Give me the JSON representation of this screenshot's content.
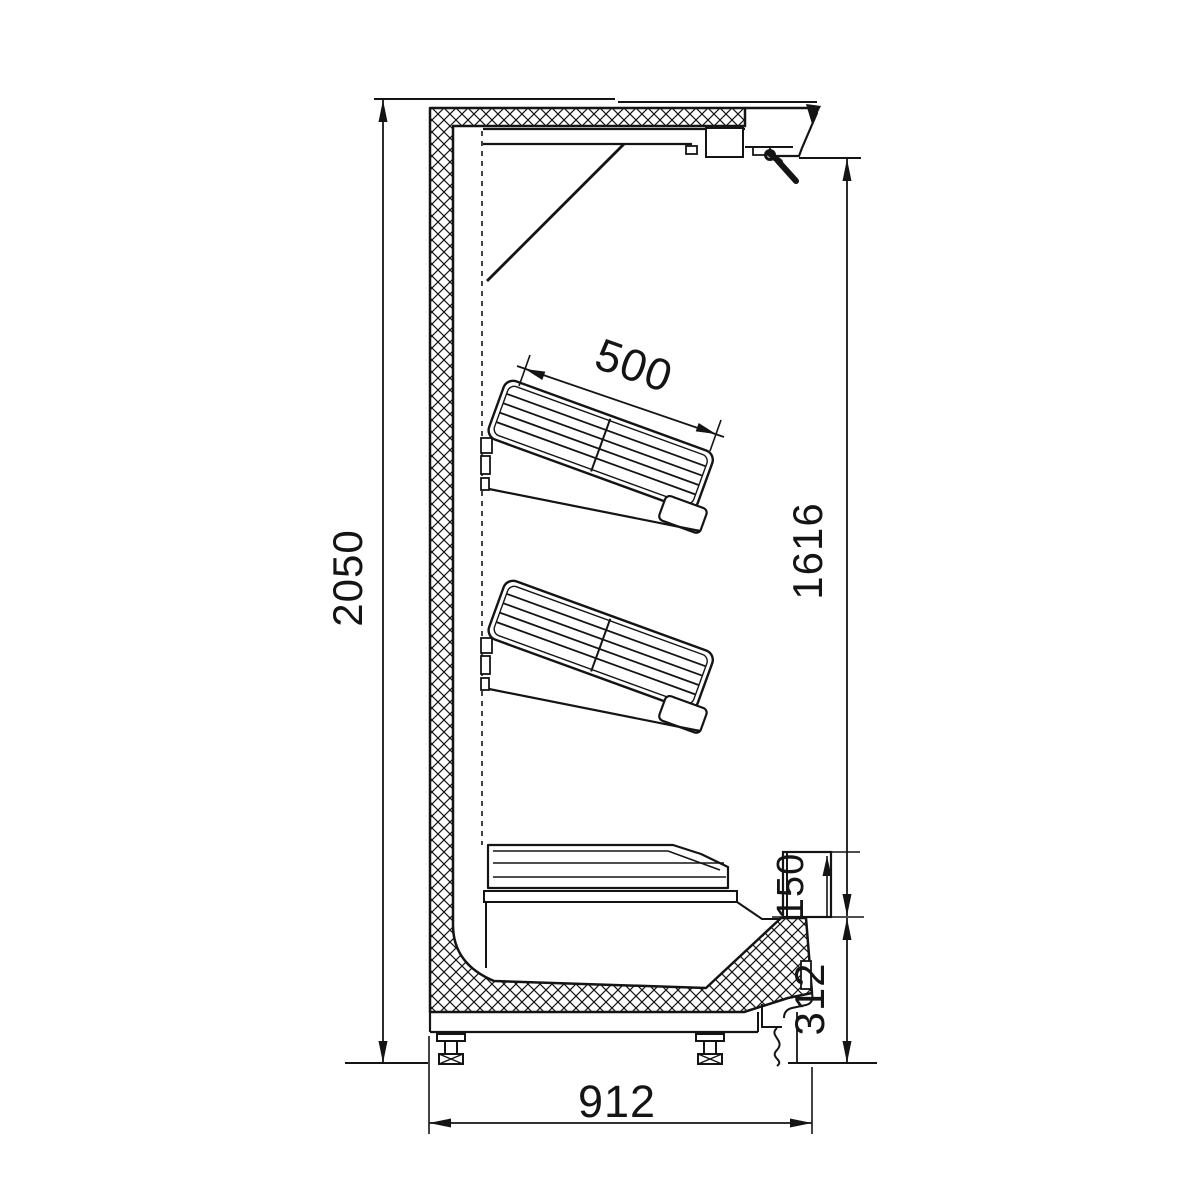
{
  "drawing": {
    "dimensions": {
      "overall_height": "2050",
      "shelf_depth": "500",
      "opening_height": "1616",
      "sill_height": "150",
      "base_height": "312",
      "overall_depth": "912"
    }
  }
}
